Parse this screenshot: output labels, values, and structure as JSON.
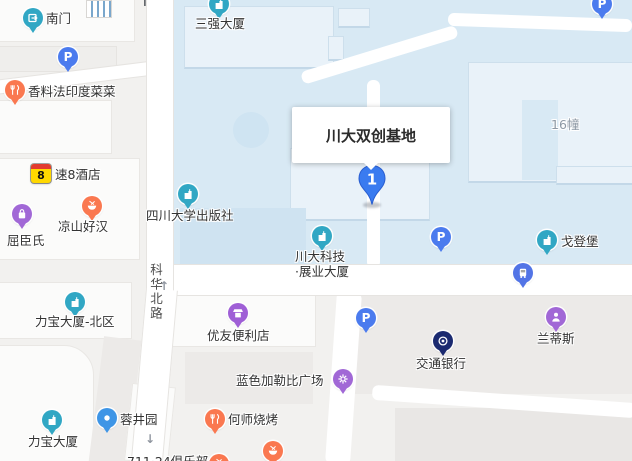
{
  "infobox": {
    "place_name": "川大双创基地"
  },
  "pin": {
    "marker_number": "1"
  },
  "road": {
    "name": "科华北路"
  },
  "colors": {
    "pin_blue": "#3a7bf0",
    "pin_edge": "#2b5fd0",
    "icon": {
      "building": "#31a7c4",
      "gate": "#31a7c4",
      "parking": "#4b7bee",
      "restaurant": "#fa7850",
      "bowl": "#fa7850",
      "bag": "#a168d6",
      "shop": "#9f5fd6",
      "ktv": "#a168d6",
      "leisure": "#a168d6",
      "bus": "#5274e6",
      "bank": "#1b2a70",
      "scenic": "#3e95e6"
    }
  },
  "static_labels": [
    {
      "name": "building-number-label",
      "text": "16幢",
      "x": 551,
      "y": 117,
      "style": "muted"
    },
    {
      "name": "partial-club-label",
      "text": "711·24俱乐部",
      "x": 127,
      "y": 454,
      "style": "normal"
    }
  ],
  "arrows": [
    {
      "name": "road-arrow-up-dark",
      "glyph": "↑",
      "x": 139,
      "y": -5,
      "color": "#5f6368",
      "size": 14
    },
    {
      "name": "road-arrow-up",
      "glyph": "↑",
      "x": 159,
      "y": 280,
      "color": "#9096a0",
      "size": 12
    },
    {
      "name": "road-arrow-down",
      "glyph": "↓",
      "x": 145,
      "y": 433,
      "color": "#9096a0",
      "size": 12
    }
  ],
  "pois": [
    {
      "name": "poi-south-gate",
      "icon": "gate",
      "x": 33,
      "y": 18,
      "label": "南门",
      "lx": 46,
      "ly": 11
    },
    {
      "name": "poi-parking-northwest",
      "icon": "parking",
      "x": 68,
      "y": 57
    },
    {
      "name": "poi-sanqiang-tower",
      "icon": "building",
      "x": 219,
      "y": 4,
      "label": "三强大厦",
      "lx": 195,
      "ly": 16
    },
    {
      "name": "poi-indian-restaurant",
      "icon": "restaurant",
      "x": 15,
      "y": 90,
      "label": "香料法印度菜菜",
      "lx": 28,
      "ly": 84
    },
    {
      "name": "poi-super8-hotel",
      "icon": "super8",
      "x": 41,
      "y": 174,
      "label": "速8酒店",
      "lx": 55,
      "ly": 167
    },
    {
      "name": "poi-liangshan-restaurant",
      "icon": "bowl",
      "x": 92,
      "y": 206,
      "label": "凉山好汉",
      "lx": 58,
      "ly": 219
    },
    {
      "name": "poi-watsons",
      "icon": "bag",
      "x": 22,
      "y": 214,
      "label": "屈臣氏",
      "lx": 7,
      "ly": 233
    },
    {
      "name": "poi-scu-press",
      "icon": "building",
      "x": 188,
      "y": 194,
      "label": "四川大学出版社",
      "lx": 146,
      "ly": 208
    },
    {
      "name": "poi-parking-northeast",
      "icon": "parking",
      "x": 602,
      "y": 4
    },
    {
      "name": "poi-libao-tower-north",
      "icon": "building",
      "x": 75,
      "y": 302,
      "label": "力宝大厦-北区",
      "lx": 35,
      "ly": 314
    },
    {
      "name": "poi-youyou-store",
      "icon": "shop",
      "x": 238,
      "y": 313,
      "label": "优友便利店",
      "lx": 207,
      "ly": 328
    },
    {
      "name": "poi-chuanda-tech-tower",
      "icon": "building",
      "x": 322,
      "y": 236,
      "label": "川大科技\n·展业大厦",
      "lx": 295,
      "ly": 249,
      "multiline": true
    },
    {
      "name": "poi-parking-center",
      "icon": "parking",
      "x": 441,
      "y": 237
    },
    {
      "name": "poi-gedengbao",
      "icon": "building",
      "x": 547,
      "y": 240,
      "label": "戈登堡",
      "lx": 561,
      "ly": 234
    },
    {
      "name": "poi-bus-stop",
      "icon": "bus",
      "x": 523,
      "y": 273
    },
    {
      "name": "poi-parking-south",
      "icon": "parking",
      "x": 366,
      "y": 318
    },
    {
      "name": "poi-landisi",
      "icon": "ktv",
      "x": 556,
      "y": 317,
      "label": "兰蒂斯",
      "lx": 537,
      "ly": 331
    },
    {
      "name": "poi-bank-of-communications",
      "icon": "bank",
      "x": 443,
      "y": 341,
      "label": "交通银行",
      "lx": 416,
      "ly": 356
    },
    {
      "name": "poi-blue-caribbean-plaza",
      "icon": "leisure",
      "x": 343,
      "y": 379,
      "label": "蓝色加勒比广场",
      "lx": 236,
      "ly": 373
    },
    {
      "name": "poi-rongjingyuan",
      "icon": "scenic",
      "x": 107,
      "y": 418,
      "label": "蓉井园",
      "lx": 120,
      "ly": 412
    },
    {
      "name": "poi-libao-tower",
      "icon": "building",
      "x": 52,
      "y": 420,
      "label": "力宝大厦",
      "lx": 28,
      "ly": 434
    },
    {
      "name": "poi-heshi-bbq",
      "icon": "restaurant",
      "x": 215,
      "y": 419,
      "label": "何师烧烤",
      "lx": 228,
      "ly": 412
    },
    {
      "name": "poi-bbq-south",
      "icon": "bowl",
      "x": 273,
      "y": 451
    },
    {
      "name": "poi-bbq-edge",
      "icon": "bowl",
      "x": 219,
      "y": 464
    }
  ]
}
